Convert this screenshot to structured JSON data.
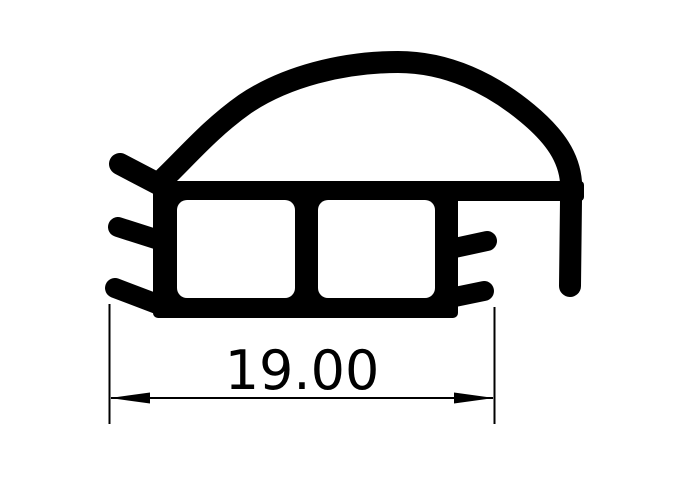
{
  "drawing": {
    "description": "Technical cross-section drawing of an extruded seal profile: a large curved bulb on top, a rectangular body with two hollow square chambers, a blunt lip and two fins on the left side, two fins and a descending leg on the right side",
    "ink_color": "#000000",
    "background_color": "#ffffff"
  },
  "dimension": {
    "label": "19.00",
    "value": 19.0
  }
}
